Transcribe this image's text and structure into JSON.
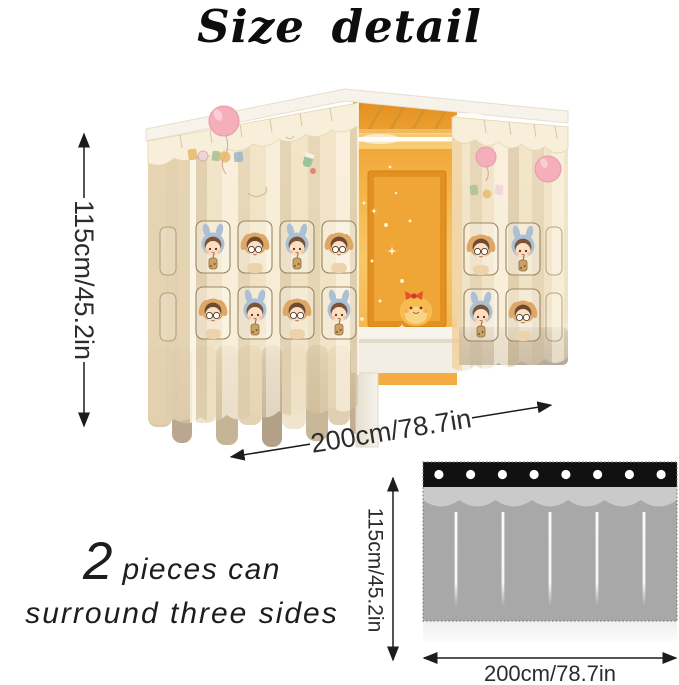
{
  "title": "Size detail",
  "photo": {
    "height_label": "115cm/45.2in",
    "width_label": "200cm/78.7in"
  },
  "note": {
    "count": "2",
    "line1": "pieces can",
    "line2": "surround three sides"
  },
  "diagram": {
    "height_label": "115cm/45.2in",
    "width_label": "200cm/78.7in",
    "grommet_count": 8,
    "fold_count": 5
  },
  "colors": {
    "curtain_cream": "#f2e5c8",
    "interior_glow": "#f3ab41",
    "balloon_pink": "#f4afbb",
    "diagram_header": "#111111",
    "diagram_valance": "#cacaca",
    "diagram_body": "#a8a8a8",
    "diagram_hem": "#f0f0f0",
    "annotation": "#1c1c1c"
  }
}
